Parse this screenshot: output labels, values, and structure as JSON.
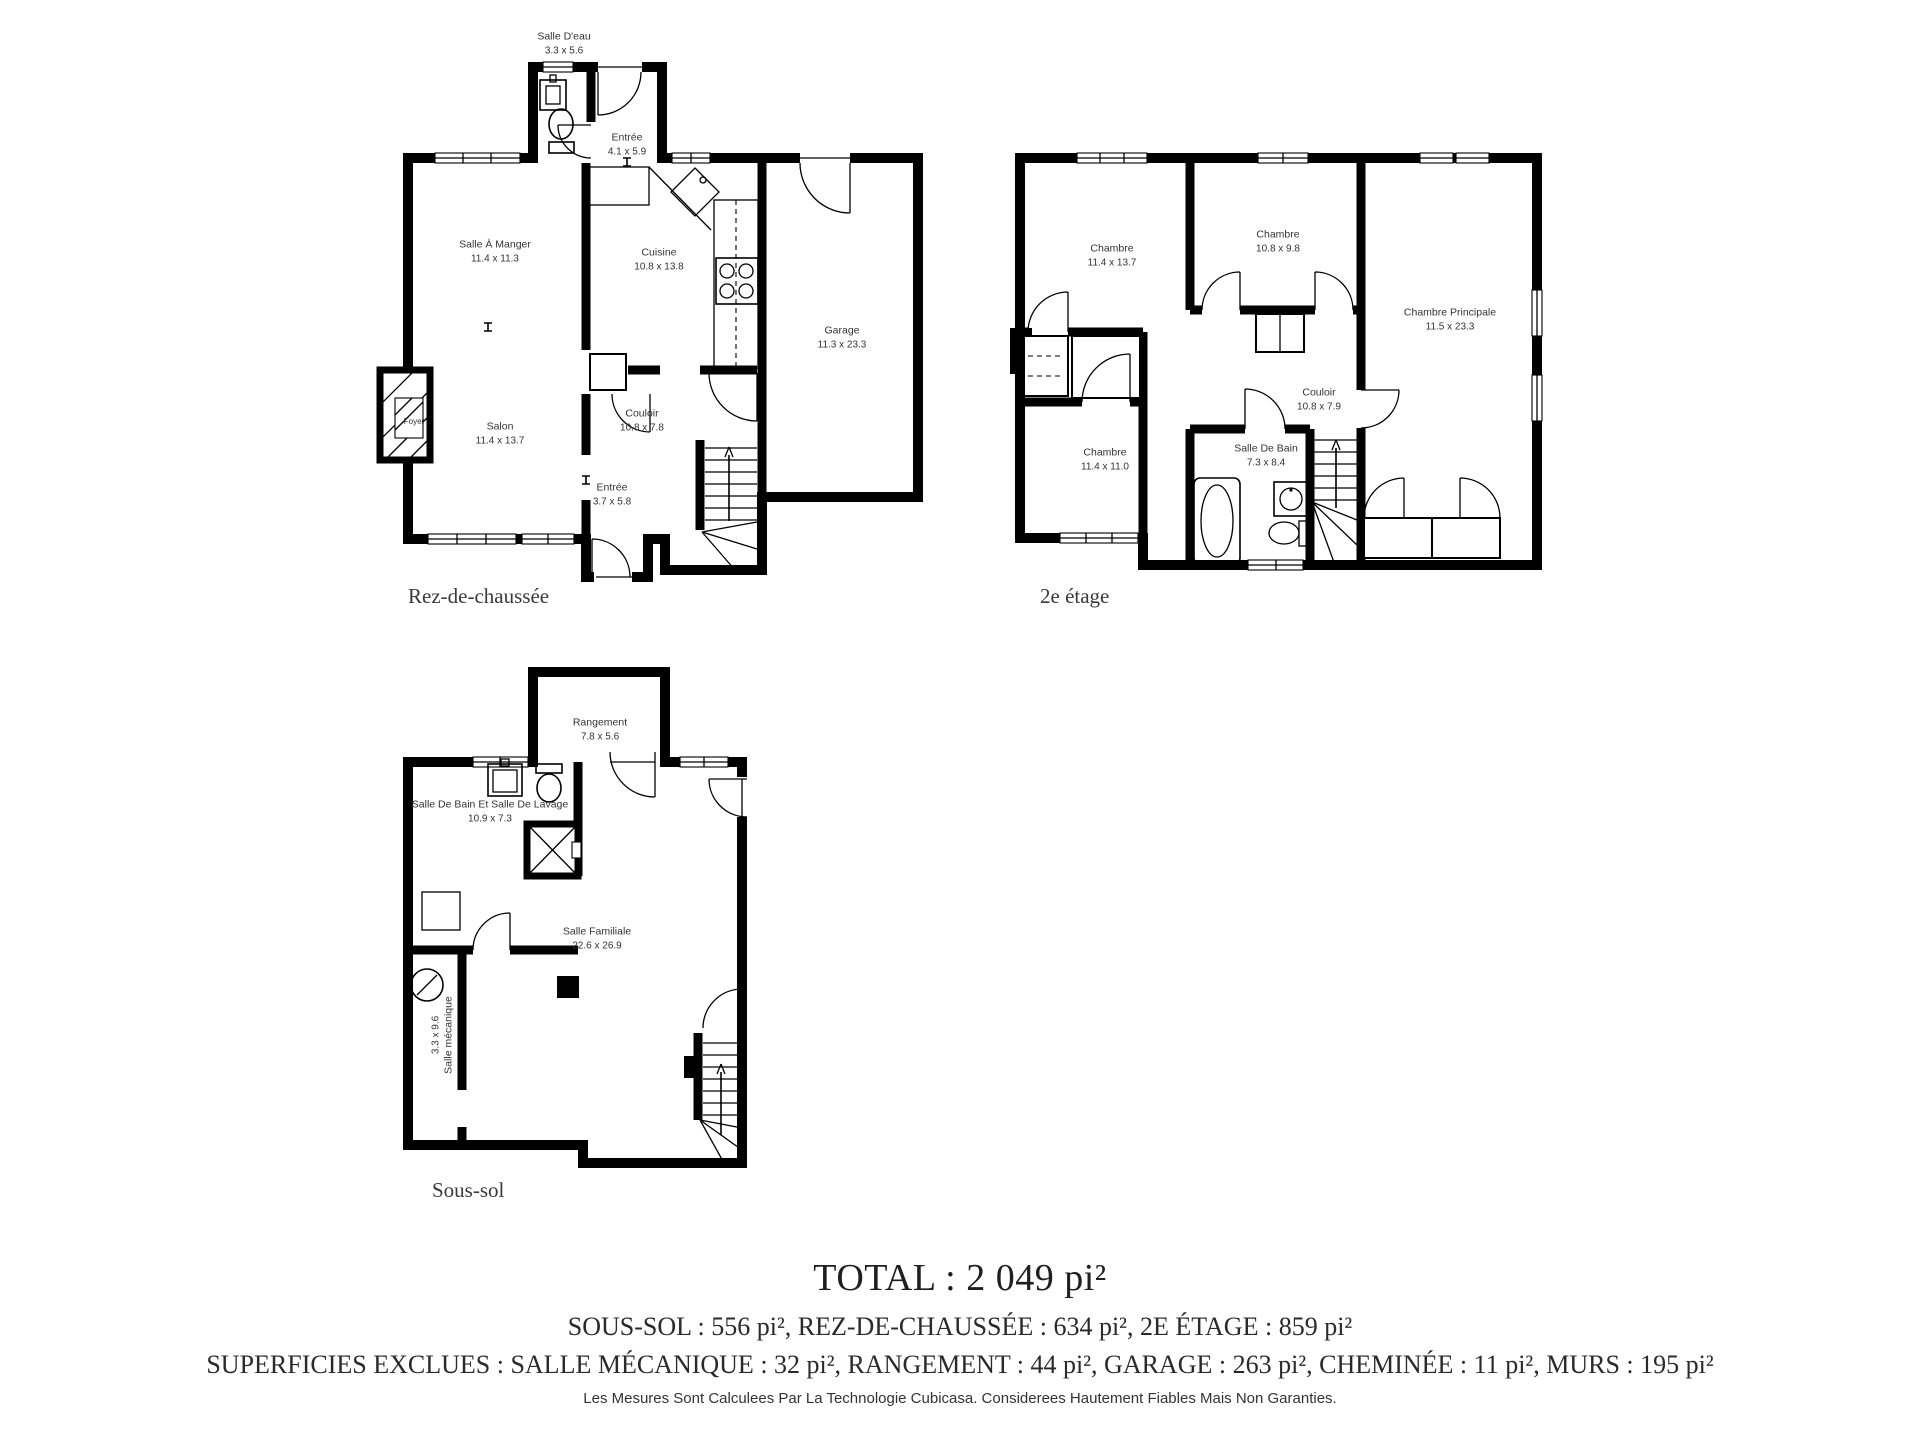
{
  "floors": [
    {
      "label": "Rez-de-chaussée",
      "rooms": [
        {
          "name": "Salle D'eau",
          "dims": "3.3 x 5.6"
        },
        {
          "name": "Entrée",
          "dims": "4.1 x 5.9"
        },
        {
          "name": "Salle À Manger",
          "dims": "11.4 x 11.3"
        },
        {
          "name": "Cuisine",
          "dims": "10.8 x 13.8"
        },
        {
          "name": "Garage",
          "dims": "11.3 x 23.3"
        },
        {
          "name": "Salon",
          "dims": "11.4 x 13.7"
        },
        {
          "name": "Couloir",
          "dims": "10.8 x 7.8"
        },
        {
          "name": "Entrée",
          "dims": "3.7 x 5.8"
        },
        {
          "name": "Foyer",
          "dims": ""
        }
      ]
    },
    {
      "label": "2e étage",
      "rooms": [
        {
          "name": "Chambre",
          "dims": "11.4 x 13.7"
        },
        {
          "name": "Chambre",
          "dims": "10.8 x 9.8"
        },
        {
          "name": "Chambre Principale",
          "dims": "11.5 x 23.3"
        },
        {
          "name": "Couloir",
          "dims": "10.8 x 7.9"
        },
        {
          "name": "Chambre",
          "dims": "11.4 x 11.0"
        },
        {
          "name": "Salle De Bain",
          "dims": "7.3 x 8.4"
        }
      ]
    },
    {
      "label": "Sous-sol",
      "rooms": [
        {
          "name": "Rangement",
          "dims": "7.8 x 5.6"
        },
        {
          "name": "Salle De Bain Et Salle De Lavage",
          "dims": "10.9 x 7.3"
        },
        {
          "name": "Salle Familiale",
          "dims": "22.6 x 26.9"
        },
        {
          "name": "Salle mécanique",
          "dims": "3.3 x 9.6"
        }
      ]
    }
  ],
  "summary": {
    "total": "TOTAL : 2 049 pi²",
    "floor_areas": "SOUS-SOL : 556 pi², REZ-DE-CHAUSSÉE : 634 pi², 2E ÉTAGE : 859 pi²",
    "excluded": "SUPERFICIES EXCLUES : SALLE MÉCANIQUE : 32 pi², RANGEMENT : 44 pi², GARAGE : 263 pi², CHEMINÉE : 11 pi², MURS : 195 pi²",
    "disclaimer": "Les Mesures Sont Calculees Par La Technologie Cubicasa. Considerees Hautement Fiables Mais Non Garanties."
  },
  "icons": {
    "toilet-icon": "ellipse+tank shape",
    "sink-icon": "square with circle",
    "stove-icon": "rect with 4 burner circles",
    "shower-icon": "square with X",
    "bathtub-icon": "rounded rect with oval",
    "water-heater-icon": "circle with slash",
    "fireplace-icon": "hatched rect",
    "stairs-icon": "treads with up arrow",
    "column-icon": "solid black square"
  },
  "colors": {
    "wall": "#000000",
    "room_label": "#333333",
    "summary_text": "#222222"
  }
}
